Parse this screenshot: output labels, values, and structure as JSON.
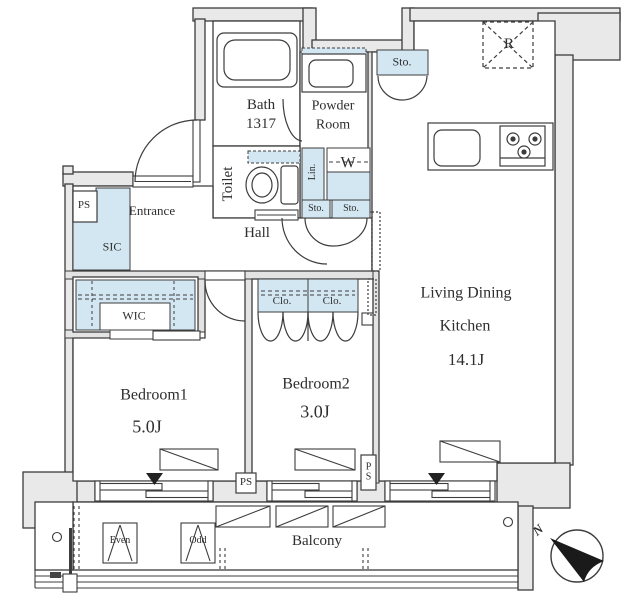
{
  "colors": {
    "fixture_blue": "#d3e7f3",
    "wall_gray": "#e9e9e9",
    "line_dark": "#3c3c3c",
    "text": "#2e2e2e"
  },
  "rooms": {
    "bath": {
      "name": "Bath",
      "size": "1317"
    },
    "powder_room": {
      "name_line1": "Powder",
      "name_line2": "Room"
    },
    "toilet": {
      "name": "Toilet"
    },
    "entrance": {
      "name": "Entrance"
    },
    "hall": {
      "name": "Hall"
    },
    "living_dining_kitchen": {
      "name_line1": "Living Dining",
      "name_line2": "Kitchen",
      "size": "14.1J"
    },
    "bedroom1": {
      "name": "Bedroom1",
      "size": "5.0J"
    },
    "bedroom2": {
      "name": "Bedroom2",
      "size": "3.0J"
    },
    "balcony": {
      "name": "Balcony"
    }
  },
  "closets": {
    "sic": "SIC",
    "wic": "WIC",
    "sto_upper": "Sto.",
    "sto_lower_left": "Sto.",
    "sto_lower_right": "Sto.",
    "linen": "Lin.",
    "washer": "W",
    "clo_left": "Clo.",
    "clo_right": "Clo."
  },
  "equipment": {
    "refrigerator": "R",
    "pipe_space_entrance": "PS",
    "pipe_space_bedroom": "PS",
    "pipe_space_ldk": "PS",
    "hatch_even": "Even",
    "hatch_odd": "Odd"
  },
  "compass": {
    "north": "N"
  }
}
